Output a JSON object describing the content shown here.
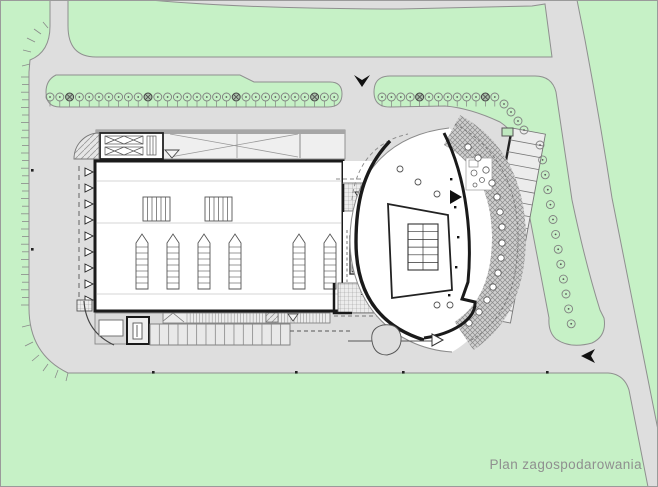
{
  "title": {
    "text": "Plan zagospodarowania"
  },
  "colors": {
    "greenery": "#c6f1c6",
    "road": "#dedede",
    "building_fill": "#ffffff",
    "wall": "#1a1a1a",
    "curb": "#8f8f8f",
    "label": "#8f8f8f",
    "canopy_fill": "#efefef",
    "pavement_band": "#cfcfcf"
  },
  "icons": {
    "entrance_arrow": "▼",
    "exit_arrow": "◀",
    "dock_door_marker": "▷",
    "plaza_arrow_up": "▲",
    "canopy_marker_down": "▽"
  }
}
